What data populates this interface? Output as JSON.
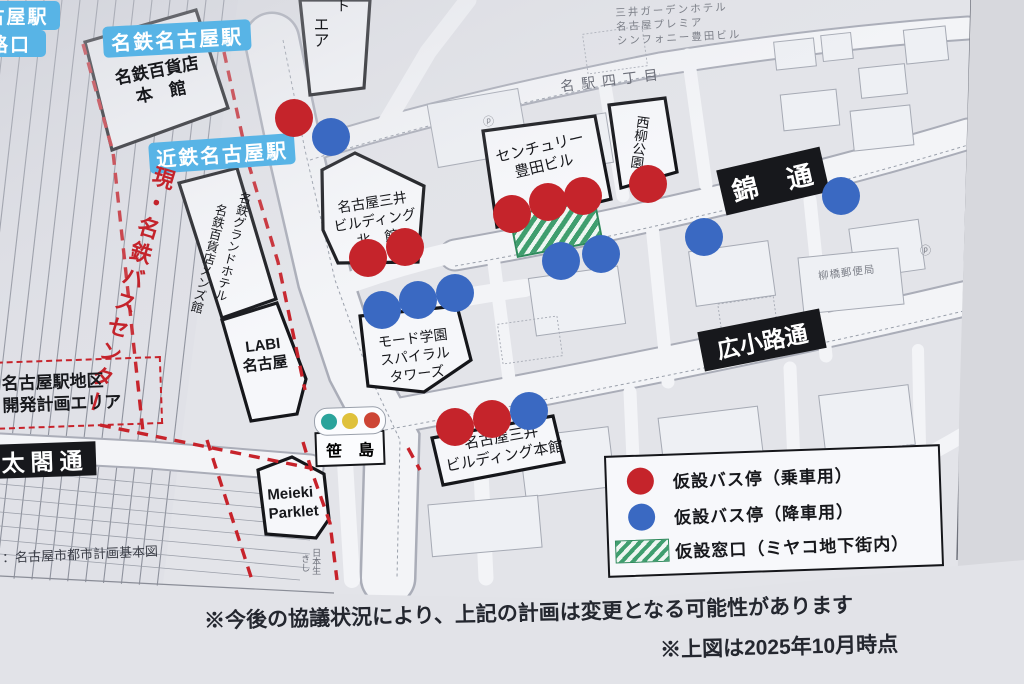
{
  "colors": {
    "boarding": "#c5242b",
    "alighting": "#3a69c2",
    "window_green": "#3f9e6e",
    "station_label_bg": "#58b4e6",
    "road_label_bg": "#17181c",
    "plan_red": "#c7232b"
  },
  "stations": {
    "corner_station_partial": "古屋駅",
    "corner_exit_partial": "路口",
    "meitetsu": "名鉄名古屋駅",
    "kintetsu": "近鉄名古屋駅"
  },
  "bus_center_label": "現・名鉄バスセンター",
  "buildings": {
    "meitetsu_dept": {
      "line1": "名鉄百貨店",
      "line2": "本　館"
    },
    "grand_hotel": "名鉄グランドホテル",
    "mens_hall": "名鉄百貨店メンズ館",
    "labi": {
      "line1": "LABI",
      "line2": "名古屋"
    },
    "mitsui_north": {
      "line1": "名古屋三井",
      "line2": "ビルディング",
      "line3": "北　館"
    },
    "mode_gakuen": {
      "line1": "モード学園",
      "line2": "スパイラル",
      "line3": "タワーズ"
    },
    "century_toyota": {
      "line1": "センチュリー",
      "line2": "豊田ビル"
    },
    "nishiyanagi_park": "西柳公園",
    "mitsui_main": {
      "line1": "名古屋三井",
      "line2": "ビルディング本館"
    },
    "meieki_parklet": {
      "line1": "Meieki",
      "line2": "Parklet"
    },
    "sasashima": "笹　島",
    "top_partial_vertical": "エア",
    "top_partial_fragment": "ト"
  },
  "roads": {
    "nishiki": "錦　通",
    "hirokoji": "広小路通",
    "taiko": "太閤通"
  },
  "areas": {
    "redevelopment": {
      "line1": "名古屋駅地区",
      "line2": "開発計画エリア"
    },
    "meieki_4chome": "名駅四丁目"
  },
  "minor_labels": {
    "mitsui_garden": {
      "line1": "三井ガーデンホテル",
      "line2": "名古屋プレミア",
      "line3": "シンフォニー豊田ビル"
    },
    "yanagibashi_post_office": "柳橋郵便局",
    "fragment_nihonsei": "日本生",
    "fragment_kishi": "きし"
  },
  "legend": {
    "items": [
      {
        "id": "boarding",
        "label": "仮設バス停（乗車用）"
      },
      {
        "id": "alighting",
        "label": "仮設バス停（降車用）"
      },
      {
        "id": "window",
        "label": "仮設窓口（ミヤコ地下街内）"
      }
    ]
  },
  "notes": {
    "disclaimer": "※今後の協議状況により、上記の計画は変更となる可能性があります",
    "as_of": "※上図は2025年10月時点",
    "source": "：名古屋市都市計画基本図"
  },
  "markers": {
    "boarding": [
      [
        294,
        118
      ],
      [
        368,
        258
      ],
      [
        405,
        247
      ],
      [
        512,
        214
      ],
      [
        548,
        202
      ],
      [
        583,
        196
      ],
      [
        648,
        184
      ],
      [
        455,
        427
      ],
      [
        492,
        419
      ]
    ],
    "alighting": [
      [
        331,
        137
      ],
      [
        382,
        310
      ],
      [
        418,
        300
      ],
      [
        455,
        293
      ],
      [
        561,
        261
      ],
      [
        601,
        254
      ],
      [
        704,
        237
      ],
      [
        841,
        196
      ],
      [
        529,
        411
      ]
    ],
    "window": {
      "x": 512,
      "y": 206,
      "w": 84,
      "h": 40,
      "rot": -11
    }
  },
  "traffic_light": {
    "colors": [
      "#2aa39b",
      "#dfc13c",
      "#cd4535"
    ]
  }
}
